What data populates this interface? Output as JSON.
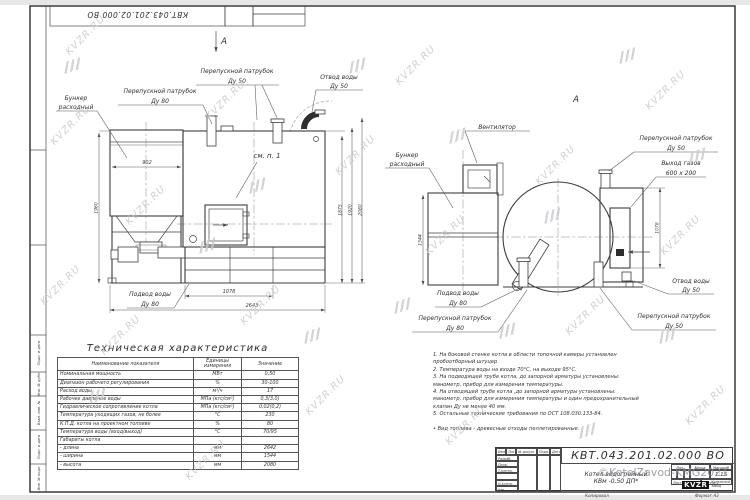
{
  "doc": {
    "number": "КВТ.043.201.02.000  ВО",
    "title1": "Котел водогрейный",
    "title2": "КВм -0,50  ДП*",
    "lit_label": "Лит.",
    "mass_label": "Масса",
    "scale_label": "Масштаб",
    "scale": "1:15",
    "sheet_label": "Лист",
    "sheets_label": "Листов 1",
    "copied_label": "Копировал",
    "format_label": "Формат А3",
    "logo_text": "KVZR",
    "logo_caption1": "Котельный",
    "logo_caption2": "завод",
    "copyright": "©KotelZavod-KMG2021",
    "cols": {
      "izm": "Изм.",
      "list": "Лист",
      "ndoc": "№ докум.",
      "podp": "Подп.",
      "data": "Дата"
    },
    "rows": {
      "r1": "Разраб.",
      "r2": "Пров.",
      "r3": "Т.контр.",
      "r4": "Н.контр.",
      "r5": "Утв."
    }
  },
  "frame": {
    "s1": "Подп. и дата",
    "s2": "Инв. № дубл.",
    "s3": "Взам. инв. №",
    "s4": "Подп. и дата",
    "s5": "Инв. № подл."
  },
  "wm": {
    "t": "KVZR.RU"
  },
  "front": {
    "a": "А",
    "see": "см. п. 1",
    "hopper1": "Бункер",
    "hopper2": "расходный",
    "by80_1": "Перепускной патрубок",
    "by80_2": "Ду 80",
    "by50_1": "Перепускной патрубок",
    "by50_2": "Ду 50",
    "out1": "Отвод воды",
    "out2": "Ду 50",
    "in1": "Подвод воды",
    "in2": "Ду 80",
    "d902": "902",
    "d1960": "1960",
    "d1875": "1875",
    "d1920": "1920",
    "d2080": "2080",
    "d1078": "1078",
    "d2643": "2643"
  },
  "side": {
    "a": "А",
    "fan": "Вентилятор",
    "hopper1": "Бункер",
    "hopper2": "расходный",
    "by50t1": "Перепускной патрубок",
    "by50t2": "Ду 50",
    "gas1": "Выход газов",
    "gas2": "600 х 200",
    "out1": "Отвод воды",
    "out2": "Ду 50",
    "by50b1": "Перепускной патрубок",
    "by50b2": "Ду 50",
    "in1": "Подвод воды",
    "in2": "Ду 80",
    "by80_1": "Перепускной патрубок",
    "by80_2": "Ду 80",
    "d1544": "1544",
    "d1078": "1078"
  },
  "spec": {
    "title": "Техническая характеристика",
    "h0": "Наименование показателя",
    "h1": "Единицы измерения",
    "h2": "Значение",
    "rows": [
      [
        "Номинальная мощность",
        "МВт",
        "0,50"
      ],
      [
        "Диапазон рабочего регулирования",
        "%",
        "30-100"
      ],
      [
        "Расход воды",
        "м³/ч",
        "17"
      ],
      [
        "Рабочее давление воды",
        "МПа (кгс/см²)",
        "0,3(3,0)"
      ],
      [
        "Гидравлическое сопротивление котла",
        "МПа (кгс/см²)",
        "0,02(0,2)"
      ],
      [
        "Температура уходящих газов, не более",
        "°С",
        "230"
      ],
      [
        "К.П.Д. котла на проектном топливе",
        "%",
        "80"
      ],
      [
        "Температура воды (вход/выход)",
        "°С",
        "70/95"
      ],
      [
        "Габариты котла",
        "",
        ""
      ],
      [
        "   - длина",
        "мм",
        "2642"
      ],
      [
        "   - ширина",
        "мм",
        "1544"
      ],
      [
        "   - высота",
        "мм",
        "2080"
      ]
    ]
  },
  "notes": {
    "l0": "1.  На боковой стенке котла в области топочной камеры установлен",
    "l1": "пробоотборный штуцер.",
    "l2": "2.  Температура воды на входе 70°С, на выходе 95°С.",
    "l3": "3.  На подводящей трубе котла, до запорной арматуры установлены:",
    "l4": "манометр, прибор для измерения температуры.",
    "l5": "4.  На отводящей трубе котла ,до запорной арматуры установлены:",
    "l6": "манометр, прибор для измерения температуры и один предохранительный",
    "l7": "клапан Ду не менее 40 мм.",
    "l8": "5.  Остальные технические требования по ОСТ 108.030.133-84.",
    "l9": "",
    "l10": "•  Вид топлива - древесные отходы пеллетированные."
  }
}
